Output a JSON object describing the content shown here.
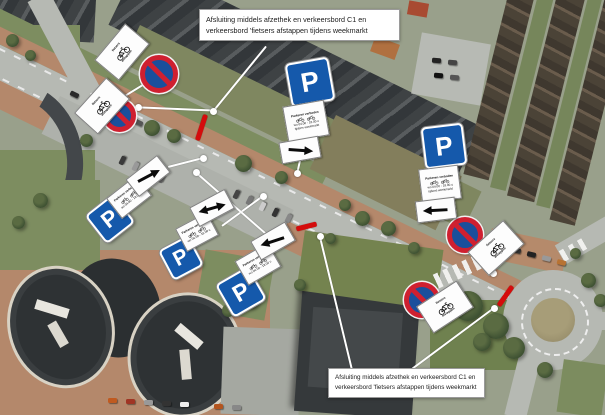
{
  "callouts": {
    "top": {
      "text": "Afsluiting middels afzethek en verkeersbord C1 en verkeersbord 'fietsers afstappen tijdens weekmarkt",
      "x": 199,
      "y": 9,
      "w": 187,
      "fs": 7.2
    },
    "bottom": {
      "text": "Afsluiting middels afzethek en verkeersbord C1 en verkeersbord 'fietsers afstappen tijdens weekmarkt",
      "x": 328,
      "y": 368,
      "w": 143,
      "fs": 6.3
    }
  },
  "labels": {
    "parking": "P",
    "cyclists_line1": "fietsers",
    "cyclists_line2": "afstappen"
  },
  "info_board": {
    "line1": "Parkeren",
    "line2": "verboden",
    "line3": "wo 04.00 - 18.00 u",
    "line4": "tijdens weekmarkt"
  },
  "colors": {
    "closure_red": "#d40c0c",
    "sign_blue": "#1559ab",
    "sign_ring_red": "#cf2030",
    "leader_white": "#ffffff"
  },
  "signs": [
    {
      "type": "no-parking",
      "cx": 159,
      "cy": 74,
      "size": 38
    },
    {
      "type": "no-parking",
      "cx": 119,
      "cy": 115,
      "size": 33
    },
    {
      "type": "no-parking",
      "cx": 465,
      "cy": 235,
      "size": 36
    },
    {
      "type": "no-parking",
      "cx": 422,
      "cy": 300,
      "size": 36
    },
    {
      "type": "cyclists",
      "cx": 121,
      "cy": 51,
      "rot": -50
    },
    {
      "type": "cyclists",
      "cx": 101,
      "cy": 105,
      "rot": -48
    },
    {
      "type": "cyclists",
      "cx": 495,
      "cy": 247,
      "rot": -42
    },
    {
      "type": "cyclists",
      "cx": 444,
      "cy": 306,
      "rot": -33
    },
    {
      "type": "parking",
      "cx": 110,
      "cy": 219,
      "size": 36,
      "rot": -38
    },
    {
      "type": "parking",
      "cx": 181,
      "cy": 258,
      "size": 34,
      "rot": -28
    },
    {
      "type": "parking",
      "cx": 241,
      "cy": 292,
      "size": 38,
      "rot": -30
    },
    {
      "type": "parking",
      "cx": 310,
      "cy": 82,
      "size": 44,
      "rot": -10
    },
    {
      "type": "parking",
      "cx": 444,
      "cy": 146,
      "size": 42,
      "rot": -7
    },
    {
      "type": "infoboard",
      "cx": 128,
      "cy": 196,
      "w": 36,
      "h": 24,
      "rot": -38,
      "rows": 2
    },
    {
      "type": "infoboard",
      "cx": 196,
      "cy": 231,
      "w": 34,
      "h": 24,
      "rot": -28,
      "rows": 2
    },
    {
      "type": "infoboard",
      "cx": 257,
      "cy": 263,
      "w": 36,
      "h": 26,
      "rot": -30,
      "rows": 2
    },
    {
      "type": "infoboard",
      "cx": 305,
      "cy": 120,
      "w": 40,
      "h": 34,
      "rot": -10,
      "rows": 3
    },
    {
      "type": "infoboard",
      "cx": 439,
      "cy": 183,
      "w": 38,
      "h": 32,
      "rot": -7,
      "rows": 3
    },
    {
      "type": "arrow",
      "dir": "right",
      "cx": 147,
      "cy": 175,
      "rot": -38,
      "arot": 10
    },
    {
      "type": "arrow",
      "dir": "both",
      "cx": 211,
      "cy": 207,
      "rot": -28,
      "arot": 12
    },
    {
      "type": "arrow",
      "dir": "left",
      "cx": 272,
      "cy": 240,
      "rot": -30,
      "arot": 12
    },
    {
      "type": "arrow",
      "dir": "right",
      "cx": 299,
      "cy": 149,
      "rot": -10,
      "arot": 14
    },
    {
      "type": "arrow",
      "dir": "left",
      "cx": 435,
      "cy": 209,
      "rot": -7,
      "arot": 4
    }
  ],
  "leader_lines": [
    {
      "x1": 266,
      "y1": 46,
      "x2": 213,
      "y2": 111
    },
    {
      "x1": 112,
      "y1": 104,
      "x2": 151,
      "y2": 80
    },
    {
      "x1": 211,
      "y1": 110,
      "x2": 138,
      "y2": 107
    },
    {
      "x1": 301,
      "y1": 155,
      "x2": 297,
      "y2": 173
    },
    {
      "x1": 168,
      "y1": 167,
      "x2": 203,
      "y2": 158
    },
    {
      "x1": 222,
      "y1": 226,
      "x2": 263,
      "y2": 196
    },
    {
      "x1": 270,
      "y1": 237,
      "x2": 196,
      "y2": 172
    },
    {
      "x1": 352,
      "y1": 369,
      "x2": 320,
      "y2": 236
    },
    {
      "x1": 494,
      "y1": 252,
      "x2": 493,
      "y2": 273
    },
    {
      "x1": 449,
      "y1": 304,
      "x2": 463,
      "y2": 297
    },
    {
      "x1": 412,
      "y1": 369,
      "x2": 494,
      "y2": 308
    }
  ],
  "leader_dots": [
    [
      213,
      111
    ],
    [
      151,
      80
    ],
    [
      138,
      107
    ],
    [
      297,
      173
    ],
    [
      203,
      158
    ],
    [
      263,
      196
    ],
    [
      196,
      172
    ],
    [
      320,
      236
    ],
    [
      493,
      273
    ],
    [
      463,
      297
    ],
    [
      494,
      308
    ]
  ],
  "closure_markers": [
    {
      "cx": 201,
      "cy": 127,
      "len": 27,
      "rot": 18
    },
    {
      "cx": 306,
      "cy": 226,
      "len": 21,
      "rot": 76
    },
    {
      "cx": 505,
      "cy": 296,
      "len": 24,
      "rot": 35
    }
  ],
  "decor": {
    "trees": [
      [
        152,
        128,
        16
      ],
      [
        174,
        136,
        14
      ],
      [
        243,
        163,
        17
      ],
      [
        281,
        177,
        13
      ],
      [
        345,
        205,
        12
      ],
      [
        362,
        218,
        15
      ],
      [
        388,
        228,
        15
      ],
      [
        86,
        140,
        13
      ],
      [
        40,
        200,
        15
      ],
      [
        18,
        222,
        13
      ],
      [
        250,
        300,
        15
      ],
      [
        228,
        310,
        13
      ],
      [
        300,
        285,
        12
      ],
      [
        468,
        306,
        30
      ],
      [
        496,
        326,
        26
      ],
      [
        514,
        348,
        22
      ],
      [
        482,
        342,
        18
      ],
      [
        545,
        370,
        16
      ],
      [
        588,
        280,
        15
      ],
      [
        600,
        300,
        13
      ],
      [
        575,
        253,
        11
      ],
      [
        30,
        55,
        11
      ],
      [
        12,
        40,
        13
      ],
      [
        330,
        238,
        11
      ],
      [
        414,
        248,
        12
      ]
    ],
    "cars": [
      [
        118,
        112,
        26,
        "#333"
      ],
      [
        134,
        120,
        26,
        "#555"
      ],
      [
        70,
        92,
        26,
        "#2a2a2a"
      ],
      [
        232,
        192,
        -64,
        "#444"
      ],
      [
        245,
        198,
        -64,
        "#777"
      ],
      [
        258,
        204,
        -64,
        "#ccc"
      ],
      [
        271,
        210,
        -64,
        "#333"
      ],
      [
        284,
        216,
        -64,
        "#888"
      ],
      [
        118,
        158,
        -64,
        "#3a3a3a"
      ],
      [
        131,
        164,
        -64,
        "#999"
      ],
      [
        144,
        170,
        -64,
        "#222"
      ],
      [
        157,
        176,
        -64,
        "#666"
      ],
      [
        108,
        398,
        0,
        "#c05a20"
      ],
      [
        126,
        399,
        0,
        "#a03524"
      ],
      [
        144,
        400,
        0,
        "#999"
      ],
      [
        162,
        401,
        0,
        "#333"
      ],
      [
        180,
        402,
        0,
        "#eee"
      ],
      [
        214,
        404,
        0,
        "#b4551e"
      ],
      [
        232,
        405,
        0,
        "#888"
      ],
      [
        497,
        244,
        14,
        "#b04030"
      ],
      [
        512,
        248,
        14,
        "#333"
      ],
      [
        527,
        252,
        14,
        "#222"
      ],
      [
        542,
        256,
        14,
        "#999"
      ],
      [
        557,
        260,
        14,
        "#b87333"
      ],
      [
        432,
        58,
        5,
        "#222"
      ],
      [
        448,
        60,
        5,
        "#444"
      ],
      [
        434,
        73,
        5,
        "#111"
      ],
      [
        450,
        75,
        5,
        "#555"
      ]
    ]
  }
}
